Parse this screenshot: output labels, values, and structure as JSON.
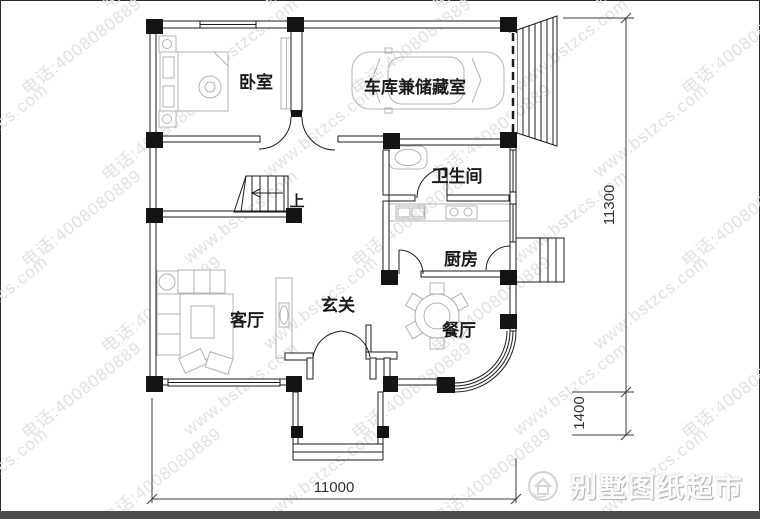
{
  "watermark": {
    "site": "www.bstzcs.com",
    "phone": "电话:4008080889"
  },
  "rooms": {
    "bedroom": "卧室",
    "garage": "车库兼储藏室",
    "bathroom": "卫生间",
    "kitchen": "厨房",
    "living": "客厅",
    "foyer": "玄关",
    "dining": "餐厅",
    "stairs_up": "上"
  },
  "dimensions": {
    "height_total": "11300",
    "bay_depth": "1400",
    "width_total": "11000"
  },
  "logo": {
    "text": "别墅图纸超市"
  }
}
